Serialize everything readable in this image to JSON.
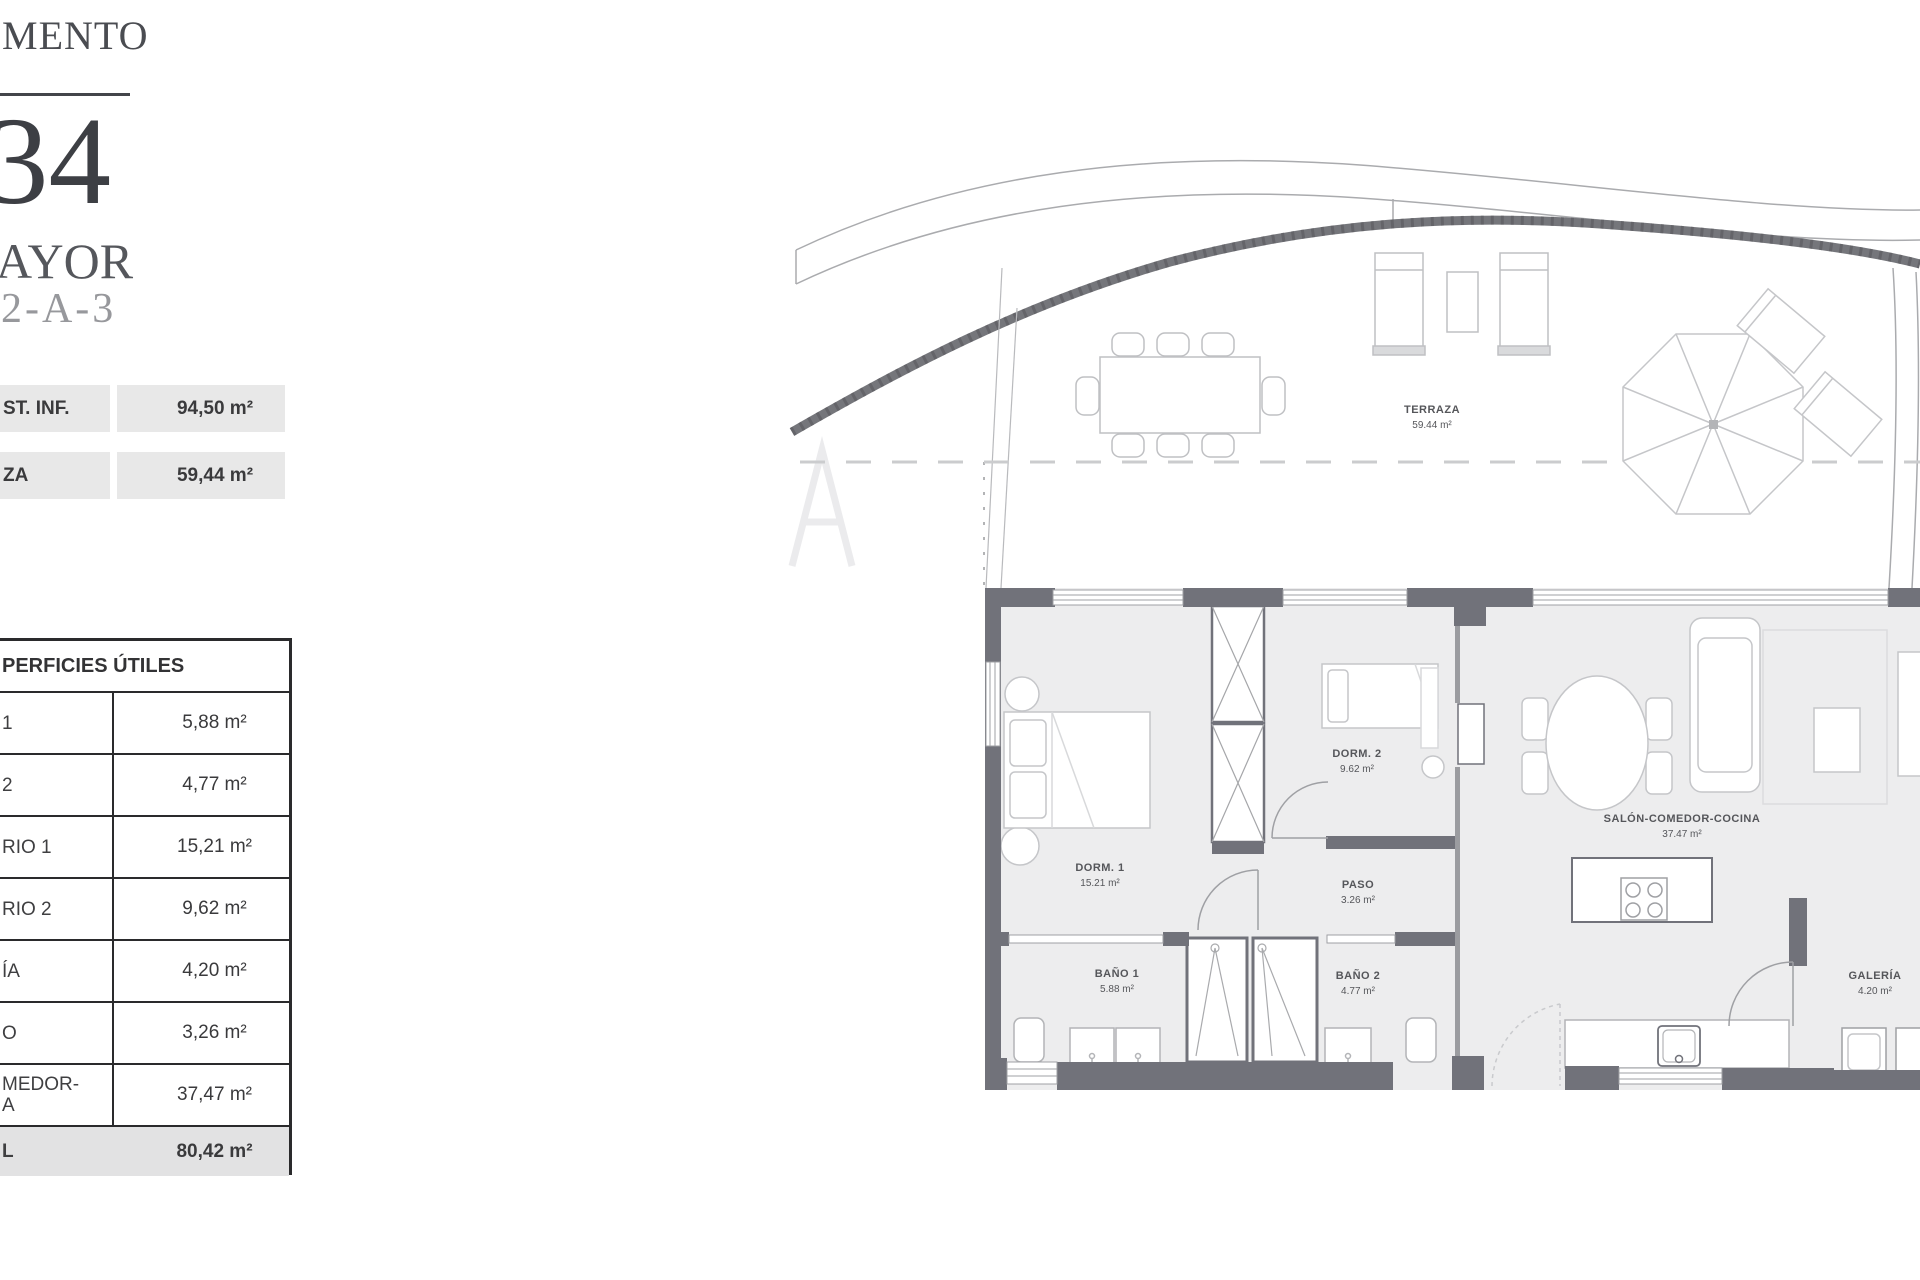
{
  "header": {
    "title_fragment": "MENTO",
    "number_fragment": "34",
    "name_fragment": "AYOR",
    "code_fragment": "-2-A-3"
  },
  "summary_table": {
    "rows": [
      {
        "label": "ST. INF.",
        "value": "94,50 m²"
      },
      {
        "label": "ZA",
        "value": "59,44 m²"
      }
    ]
  },
  "areas_table": {
    "header": "PERFICIES ÚTILES",
    "rows": [
      {
        "label": "1",
        "value": "5,88 m²"
      },
      {
        "label": "2",
        "value": "4,77 m²"
      },
      {
        "label": "RIO 1",
        "value": "15,21 m²"
      },
      {
        "label": "RIO 2",
        "value": "9,62 m²"
      },
      {
        "label": "ÍA",
        "value": "4,20 m²"
      },
      {
        "label": "O",
        "value": "3,26 m²"
      },
      {
        "label_line1": "MEDOR-",
        "label_line2": "A",
        "value": "37,47 m²"
      },
      {
        "label": "L",
        "value": "80,42 m²"
      }
    ]
  },
  "floorplan": {
    "rooms": {
      "terraza": {
        "name": "TERRAZA",
        "area": "59.44 m²"
      },
      "dorm1": {
        "name": "DORM. 1",
        "area": "15.21 m²"
      },
      "dorm2": {
        "name": "DORM. 2",
        "area": "9.62 m²"
      },
      "paso": {
        "name": "PASO",
        "area": "3.26 m²"
      },
      "bano1": {
        "name": "BAÑO 1",
        "area": "5.88 m²"
      },
      "bano2": {
        "name": "BAÑO 2",
        "area": "4.77 m²"
      },
      "salon": {
        "name": "SALÓN-COMEDOR-COCINA",
        "area": "37.47 m²"
      },
      "galeria": {
        "name": "GALERÍA",
        "area": "4.20 m²"
      }
    }
  },
  "colors": {
    "wall_gray": "#71727a",
    "furniture_line": "#c5c6c9",
    "table_band": "#e8e8e8",
    "total_band": "#e2e2e3",
    "text_dark": "#3a3a3c"
  }
}
